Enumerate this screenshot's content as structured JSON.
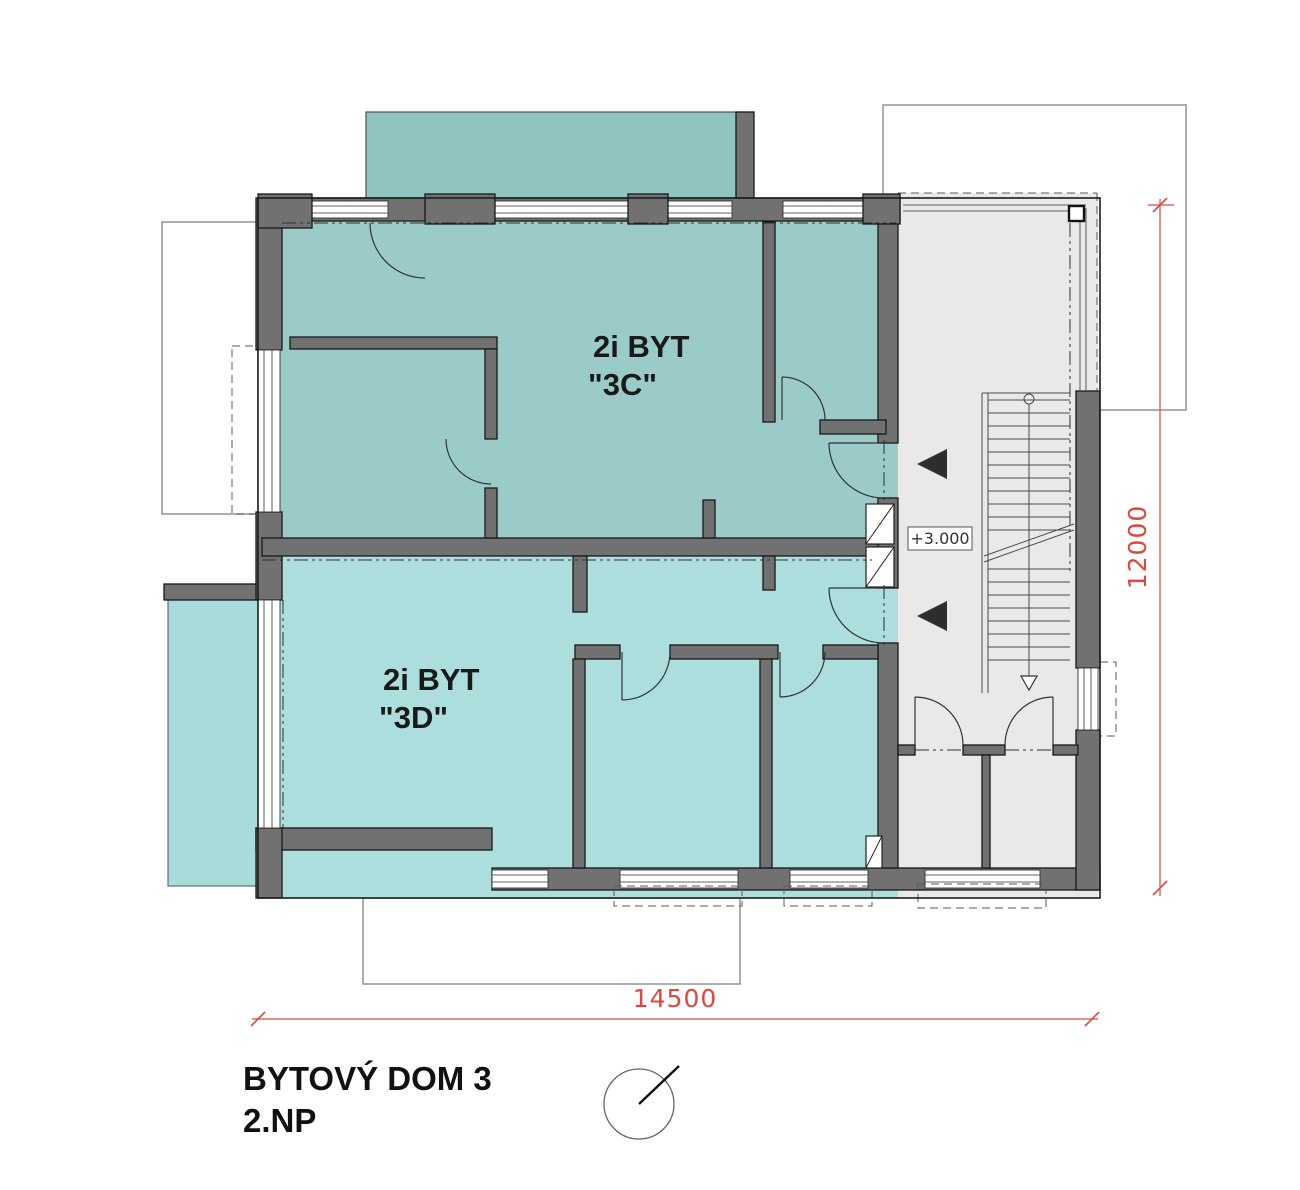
{
  "drawing": {
    "title_line1": "BYTOVÝ DOM 3",
    "title_line2": "2.NP",
    "apartments": [
      {
        "id": "3C",
        "name_line1": "2i BYT",
        "name_line2": "\"3C\"",
        "fill": "#9bcbc8"
      },
      {
        "id": "3D",
        "name_line1": "2i BYT",
        "name_line2": "\"3D\"",
        "fill": "#abdedc"
      }
    ],
    "elevation_label": "+3.000",
    "dimensions": {
      "width_mm": "14500",
      "height_mm": "12000"
    },
    "colors": {
      "wall_gray": "#717171",
      "hall_fill": "#e9e9e8",
      "balcony_top_fill": "#8fc4c1",
      "balcony_left_fill": "#a8dcda",
      "dimension_red": "#e0473c",
      "label_ink": "#1a1a1a"
    },
    "symbols": {
      "north_symbol": "north-arrow",
      "entry_marker": "left-pointing-triangle",
      "stair_run": "arrow-down"
    }
  }
}
